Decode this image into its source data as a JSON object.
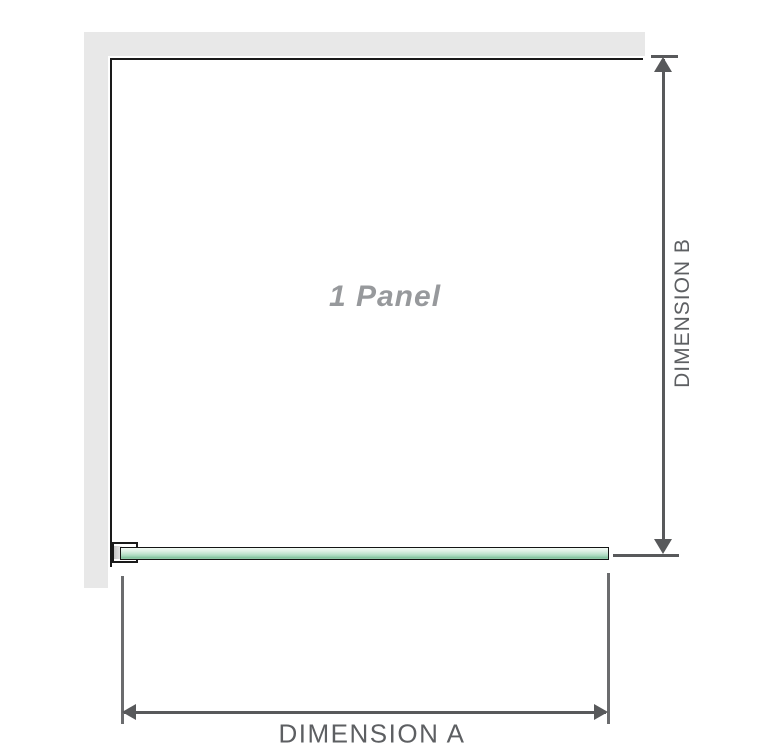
{
  "diagram": {
    "title": "1 Panel",
    "dimensions": {
      "a_label": "DIMENSION A",
      "b_label": "DIMENSION B"
    },
    "colors": {
      "wall_gray": "#e8e8e8",
      "outline_black": "#1a1a1a",
      "glass_green_light": "#ddf0e5",
      "glass_green_dark": "#7fc09b",
      "dimension_gray": "#58595b",
      "extension_gray": "#6b6c6e",
      "label_text_gray": "#5d5f62",
      "panel_label_gray": "#97999c"
    }
  }
}
